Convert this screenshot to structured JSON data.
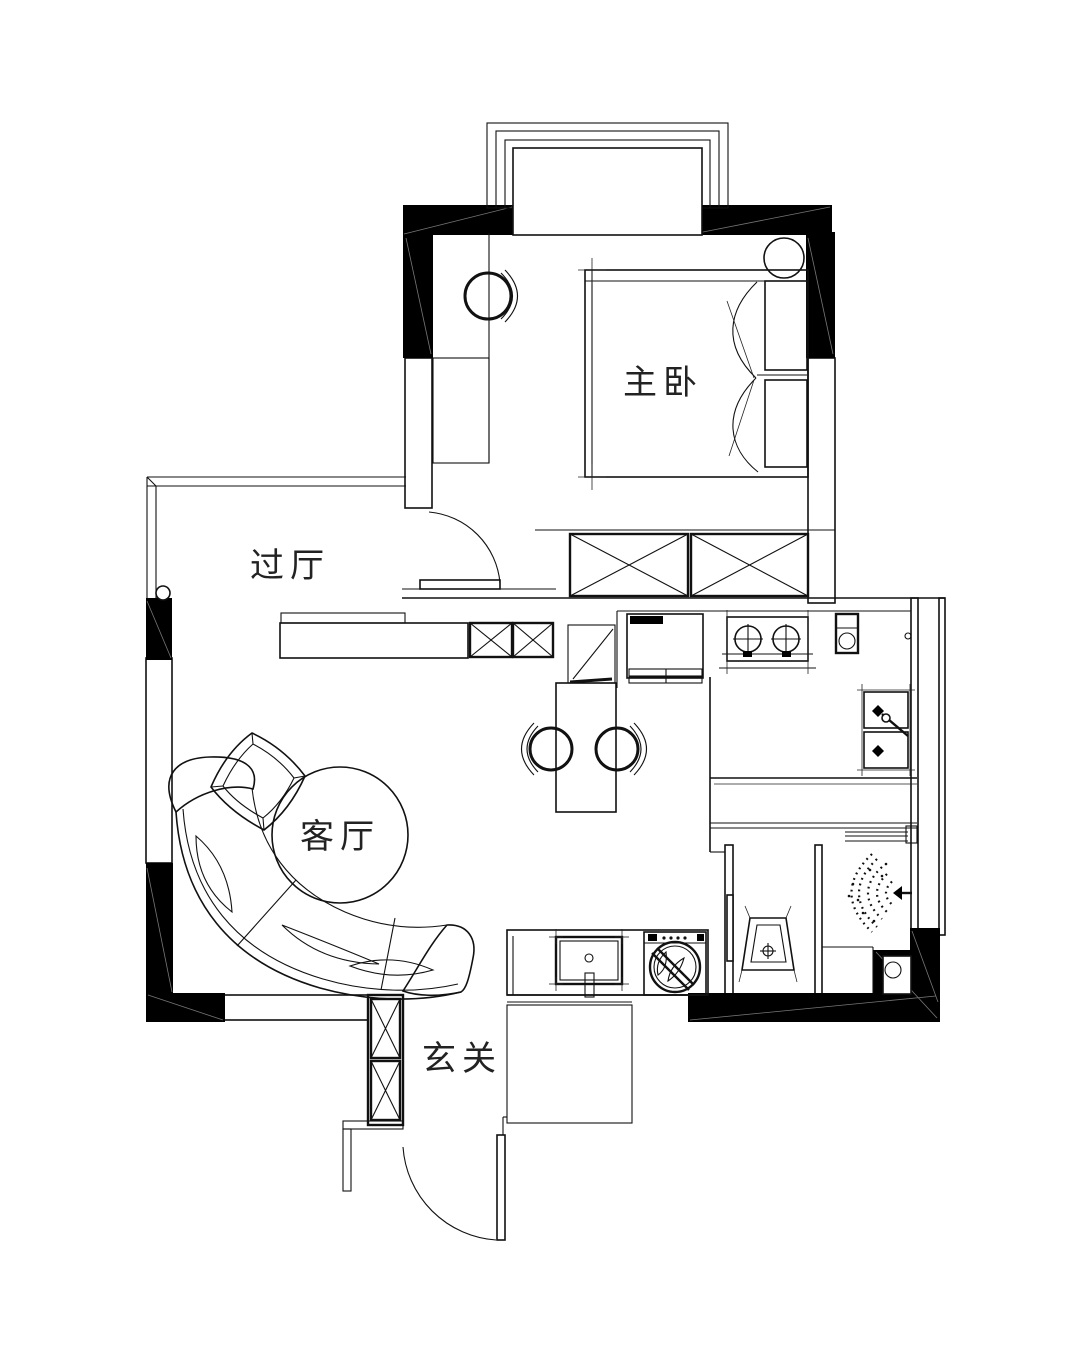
{
  "floor_plan": {
    "type": "apartment-floor-plan",
    "background": "#ffffff",
    "wall_color": "#000000",
    "line_color": "#111111",
    "rooms": [
      {
        "id": "master-bedroom",
        "label": "主卧"
      },
      {
        "id": "hallway",
        "label": "过厅"
      },
      {
        "id": "living-room",
        "label": "客厅"
      },
      {
        "id": "entry",
        "label": "玄关"
      }
    ],
    "furniture": [
      "bay-window",
      "double-bed",
      "pillows",
      "quilt",
      "nightstand",
      "vanity-counter",
      "stool",
      "wardrobe",
      "tv-cabinet",
      "storage-boxes",
      "folding-chair",
      "dining-table",
      "dining-chairs",
      "refrigerator",
      "gas-stove",
      "water-heater",
      "kitchen-sink",
      "kitchen-counter",
      "sliding-door",
      "toilet",
      "shower",
      "floor-drain",
      "laundry-counter",
      "laundry-sink",
      "washing-machine",
      "shoe-cabinet",
      "entry-door",
      "bedroom-door",
      "curved-sofa",
      "sofa-pillows",
      "ottoman",
      "wall-lamp"
    ]
  }
}
